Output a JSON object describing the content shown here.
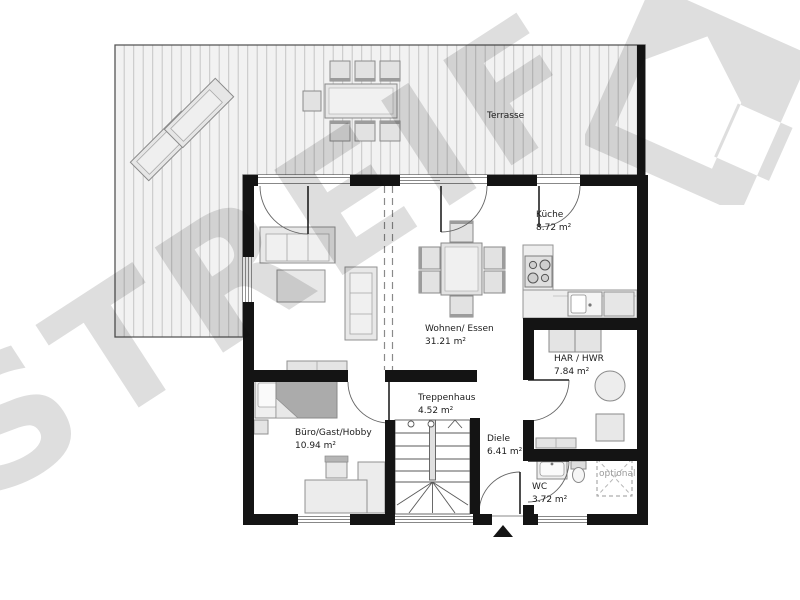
{
  "plan": {
    "brand_watermark": "STREIF",
    "colors": {
      "wall": "#141414",
      "watermark": "#dedede",
      "deck_line": "#c6c6c6"
    },
    "rooms": {
      "terrace": {
        "label": "Terrasse"
      },
      "kitchen": {
        "label": "Küche",
        "area": "8.72 m²"
      },
      "living_dining": {
        "label": "Wohnen/ Essen",
        "area": "31.21 m²"
      },
      "utility": {
        "label": "HAR / HWR",
        "area": "7.84 m²"
      },
      "stairs": {
        "label": "Treppenhaus",
        "area": "4.52 m²"
      },
      "office": {
        "label": "Büro/Gast/Hobby",
        "area": "10.94 m²"
      },
      "hall": {
        "label": "Diele",
        "area": "6.41 m²"
      },
      "wc": {
        "label": "WC",
        "area": "3.72 m²"
      },
      "optional_feature": {
        "label": "optional"
      }
    }
  }
}
